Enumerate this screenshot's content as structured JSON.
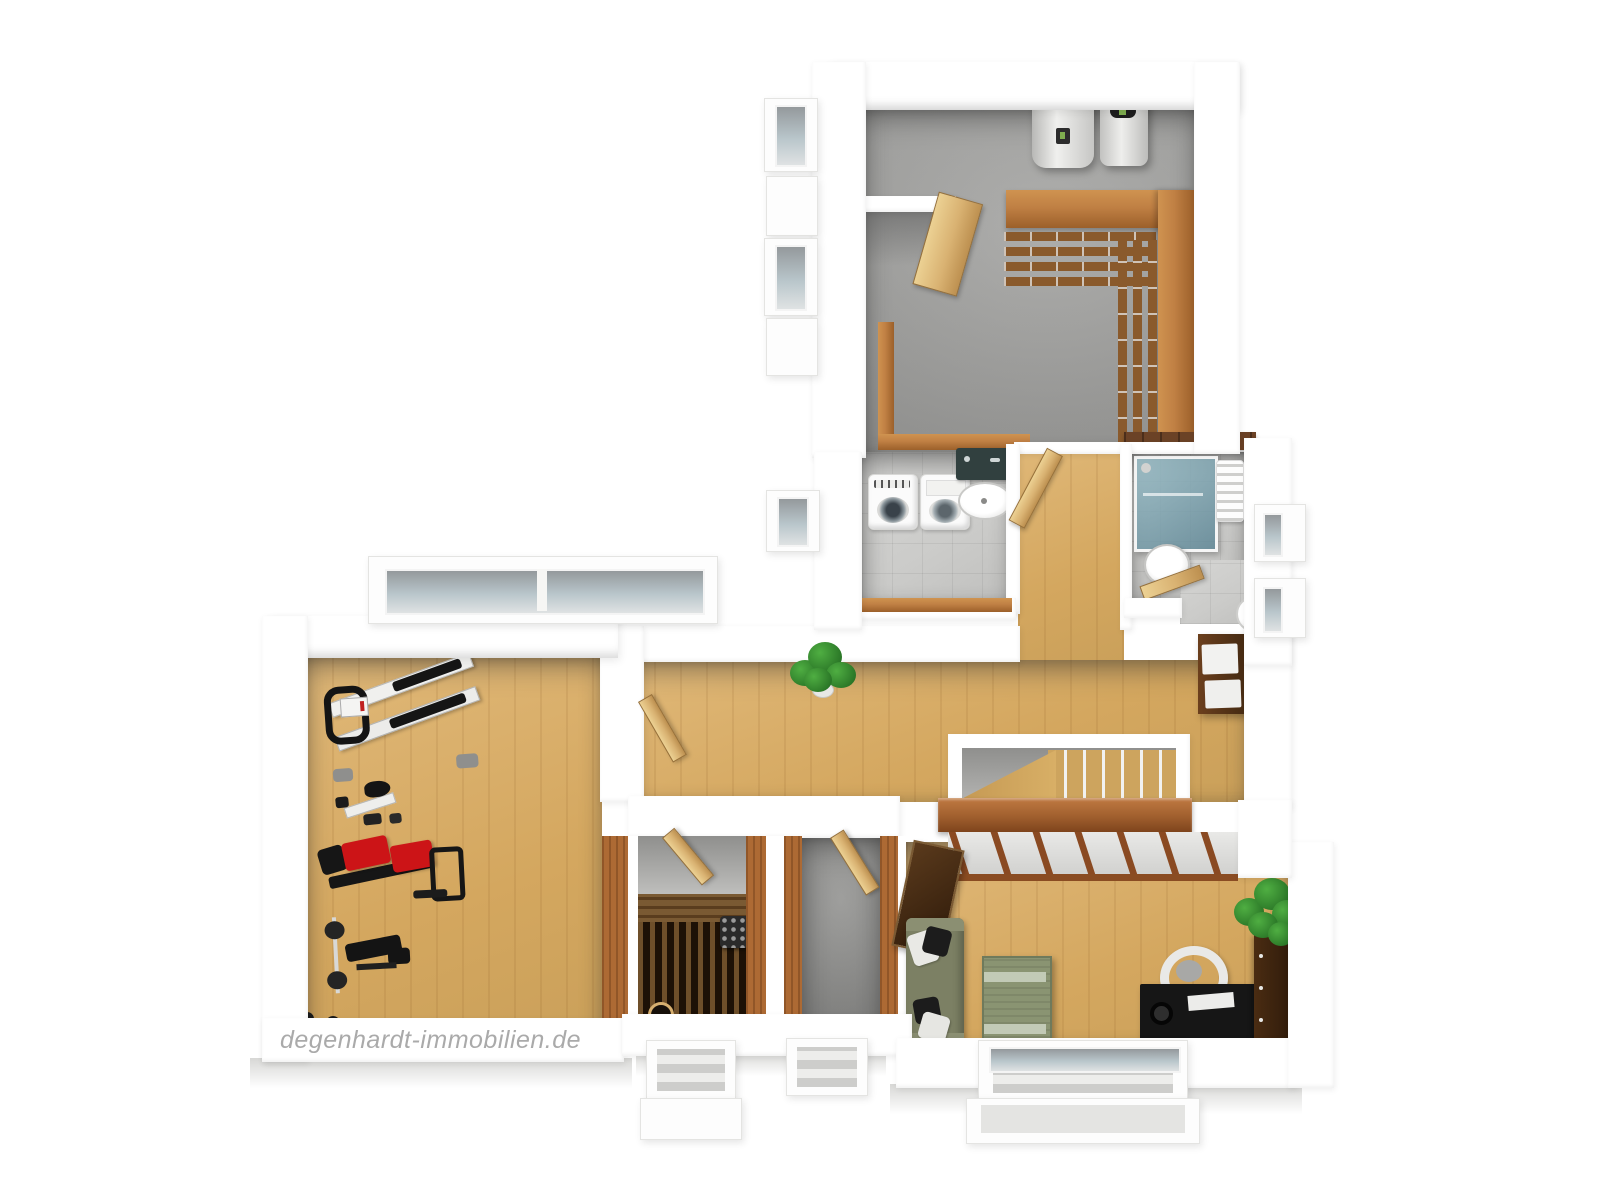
{
  "watermark": "degenhardt-immobilien.de",
  "theme": {
    "bg": "#ffffff",
    "wall": "#ffffff",
    "concrete": "#9c9c9a",
    "concrete_dark": "#8b8b89",
    "tile": "#cbcbc9",
    "wood_floor": "#d4a75f",
    "wood_floor_light": "#e0b878",
    "door_wood": "#d9b272",
    "shelf_wood": "#b27a3c",
    "shelf_dark": "#8a5a2c",
    "knee_wood": "#c08044",
    "panel_wood": "#ad6a34",
    "handrail_wood": "#a05f2e",
    "cap_dark_wood": "#6b4226",
    "sauna_dark": "#1d1106",
    "sauna_slat": "#6e4f2a",
    "sauna_bench": "#7a5a33",
    "furniture_red": "#cc1417",
    "sofa_green": "#7c8064",
    "table_green": "#8a9472",
    "table_stripe": "#c2cab6",
    "plant_dark": "#1e641e",
    "desk_black": "#161616",
    "cabinet_dark": "#4a2d14",
    "glass": "#b9c6cb",
    "watermark": "#aaaaaa"
  },
  "scene": {
    "type": "3d-floorplan-rendering",
    "view": "top-down-birdseye",
    "rooms": [
      {
        "name": "utility-room",
        "floor": "concrete",
        "items": [
          "hot-water-tank",
          "heating-unit",
          "wall-shelving",
          "open-door",
          "storage-knee-wall",
          "window-lightwell"
        ]
      },
      {
        "name": "laundry-room",
        "floor": "tile",
        "items": [
          "washing-machine",
          "tumble-dryer",
          "utility-sink",
          "window-lightwell"
        ]
      },
      {
        "name": "bathroom",
        "floor": "tile",
        "items": [
          "glass-shower",
          "washbasin",
          "toilet",
          "towel-radiator",
          "door"
        ]
      },
      {
        "name": "hallway",
        "floor": "parquet",
        "items": [
          "potted-plant",
          "drawer-cabinet",
          "doors"
        ]
      },
      {
        "name": "staircase",
        "floor": "wood-steps",
        "items": [
          "winder-stairs",
          "handrail-wall",
          "built-in-closet"
        ]
      },
      {
        "name": "fitness-room",
        "floor": "parquet",
        "items": [
          "bench-press-machine",
          "exercise-bike",
          "multi-gym-red",
          "weight-bench-with-barbell",
          "dumbbell",
          "window-lightwell"
        ]
      },
      {
        "name": "sauna",
        "floor": "dark-wood",
        "items": [
          "sauna-benches",
          "sauna-heater",
          "sauna-light",
          "door"
        ]
      },
      {
        "name": "cellar-room",
        "floor": "concrete",
        "items": [
          "door",
          "window-lightwell"
        ]
      },
      {
        "name": "living-room",
        "floor": "parquet",
        "items": [
          "sofa",
          "cushions",
          "coffee-table",
          "desk",
          "office-chair",
          "shelf",
          "potted-plant",
          "wall-panel",
          "window-lightwell"
        ]
      }
    ]
  }
}
